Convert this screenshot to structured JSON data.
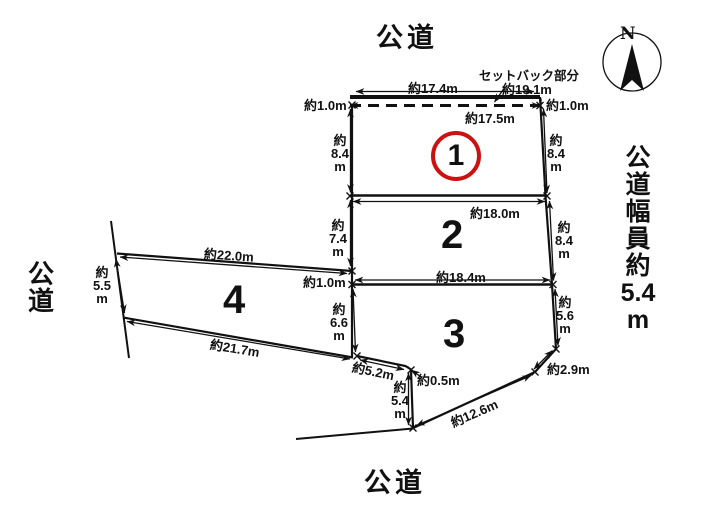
{
  "roads": {
    "top": "公道",
    "bottom": "公道",
    "left": "公\n道",
    "right": "公\n道\n幅\n員\n約\n5.4\nm"
  },
  "compass": {
    "north": "N"
  },
  "setback": {
    "label": "セットバック部分",
    "dim": "約19.1m"
  },
  "plots": {
    "p1": "1",
    "p2": "2",
    "p3": "3",
    "p4": "4"
  },
  "dims": {
    "d17_4": "約17.4m",
    "d17_5": "約17.5m",
    "d1_0_left_top": "約1.0m",
    "d1_0_right_top": "約1.0m",
    "d1_0_mid": "約1.0m",
    "d8_4_l1": "約\n8.4\nm",
    "d8_4_r1": "約\n8.4\nm",
    "d18_0": "約18.0m",
    "d7_4": "約\n7.4\nm",
    "d8_4_r2": "約\n8.4\nm",
    "d18_4": "約18.4m",
    "d22_0": "約22.0m",
    "d5_5": "約\n5.5\nm",
    "d21_7": "約21.7m",
    "d6_6": "約\n6.6\nm",
    "d5_6": "約\n5.6\nm",
    "d5_2": "約5.2m",
    "d0_5": "約0.5m",
    "d5_4": "約\n5.4\nm",
    "d12_6": "約12.6m",
    "d2_9": "約2.9m"
  }
}
